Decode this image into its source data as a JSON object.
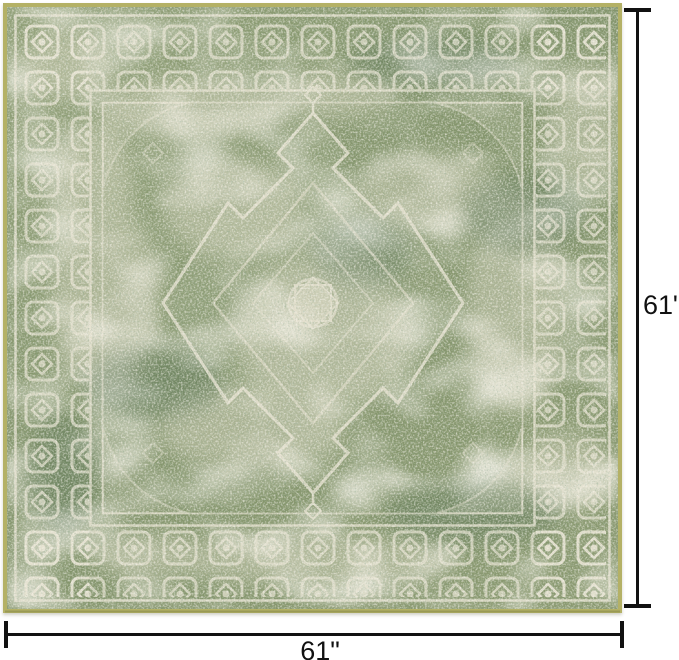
{
  "scene": {
    "description": "Square distressed vintage medallion area rug shown flat on white, annotated with width and height dimension lines",
    "background_color": "#ffffff",
    "annotation_color": "#111111"
  },
  "rug": {
    "style": "distressed traditional medallion rug",
    "shape": "square",
    "colors": {
      "edge_binding": "#b4b166",
      "base_green": "#87976e",
      "dark_green": "#4e6a50",
      "cream": "#e9e4d3"
    }
  },
  "dimensions": {
    "width_label": "61\"",
    "height_label": "61\""
  }
}
